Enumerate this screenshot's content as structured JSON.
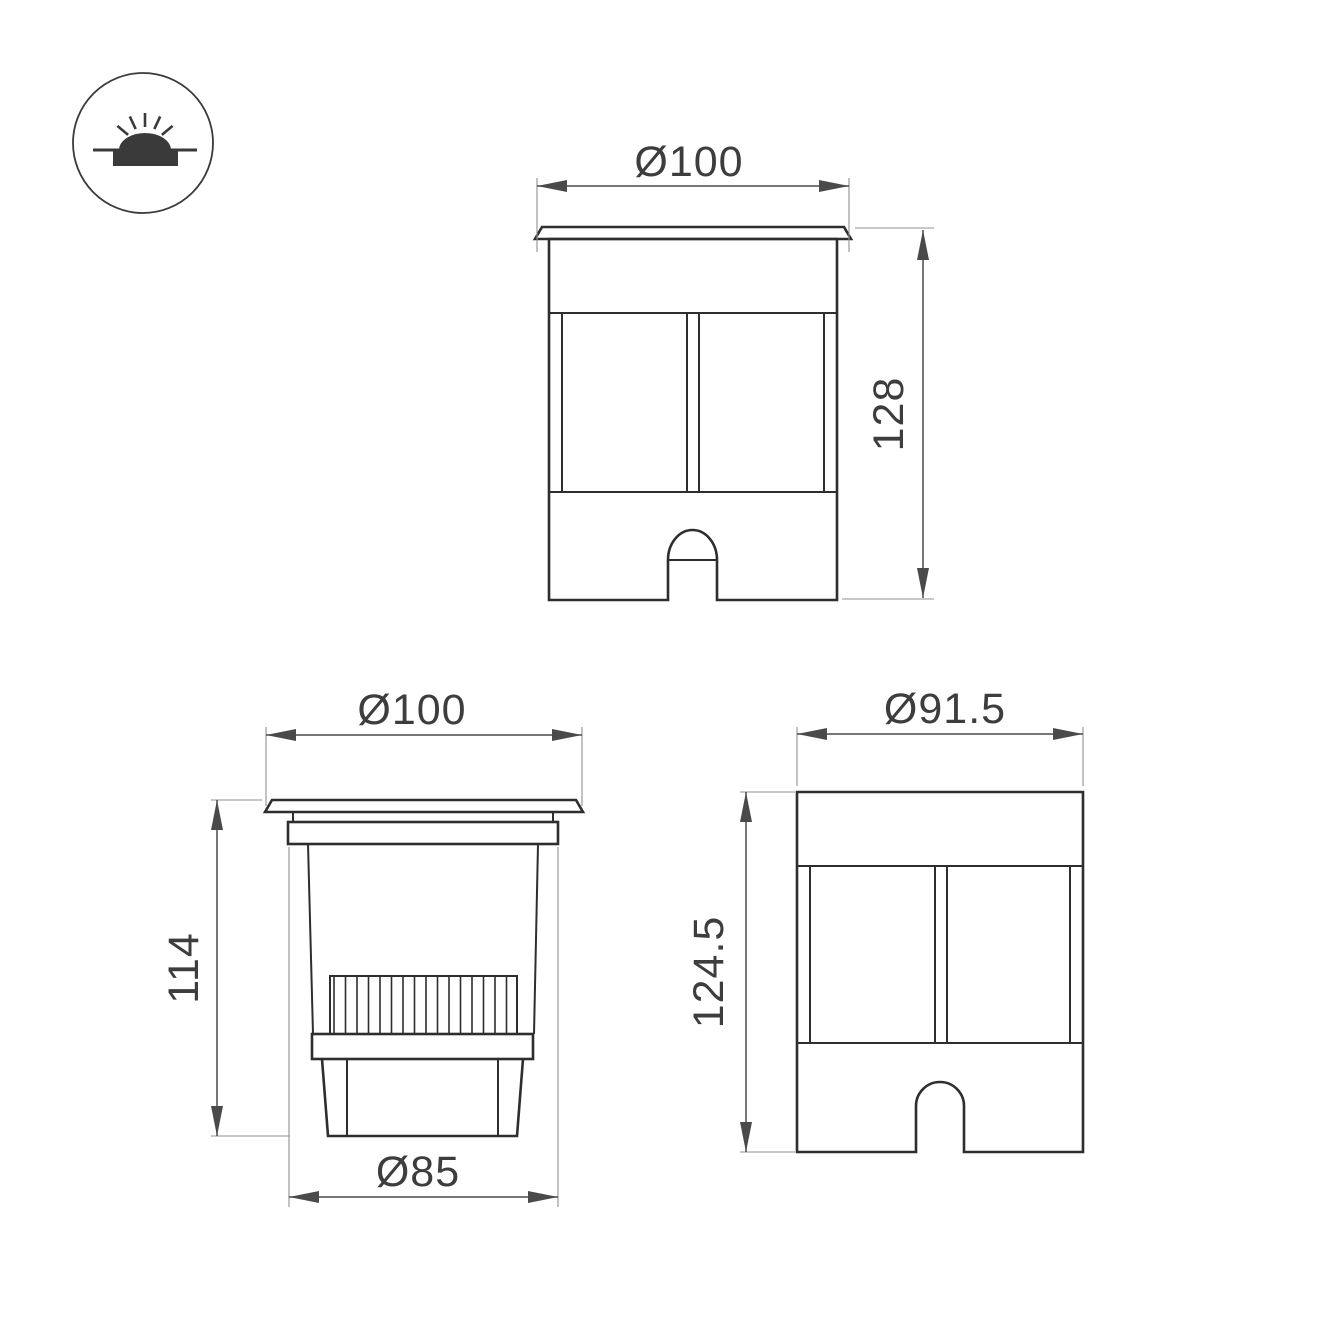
{
  "colors": {
    "background": "#ffffff",
    "line": "#2e2e2e",
    "dimension": "#4a4a4a",
    "extension": "#909090",
    "text": "#3d3d3d",
    "icon": "#3a3a3a"
  },
  "icon": {
    "name": "recessed-ground-light-icon"
  },
  "views": {
    "front": {
      "width_label": "Ø100",
      "height_label": "128"
    },
    "section": {
      "top_width_label": "Ø100",
      "height_label": "114",
      "bottom_width_label": "Ø85"
    },
    "side": {
      "width_label": "Ø91.5",
      "height_label": "124.5"
    }
  }
}
